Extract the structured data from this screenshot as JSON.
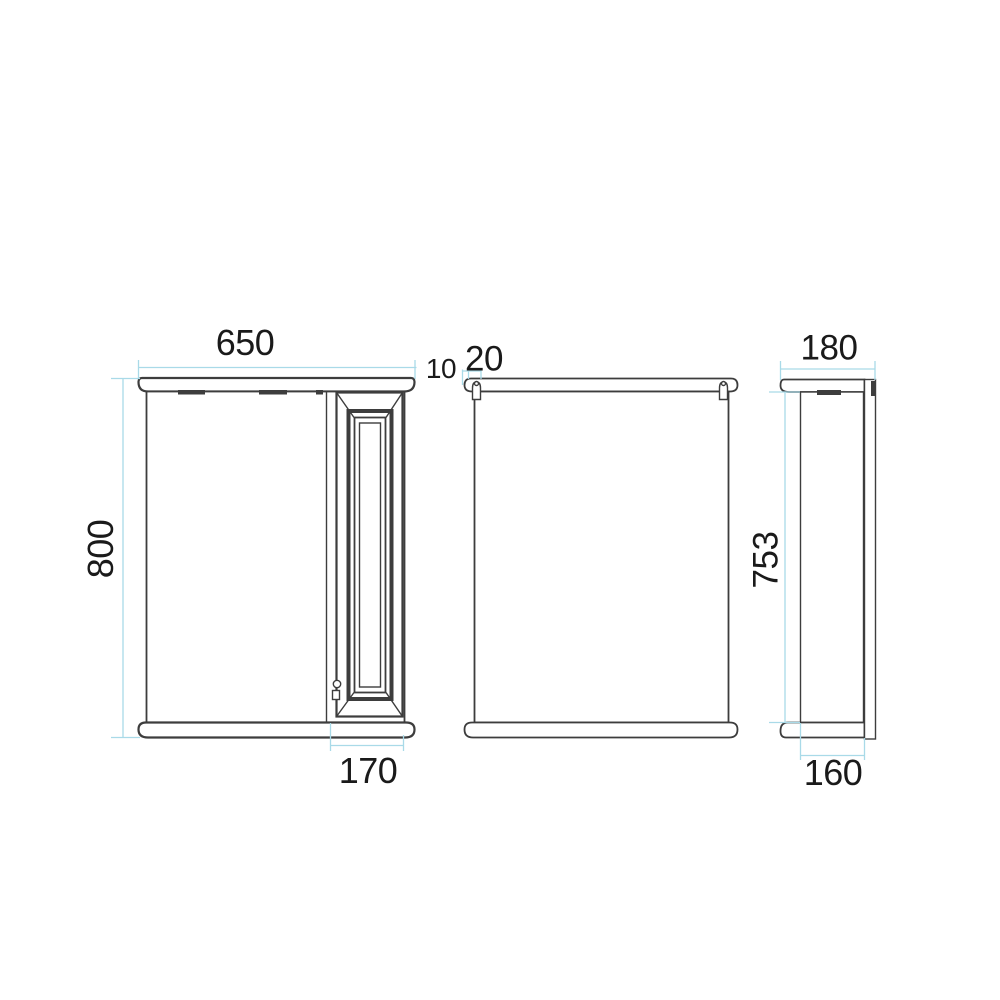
{
  "colors": {
    "background": "#ffffff",
    "object_line": "#3d3d3d",
    "dimension_line": "#a9dae8",
    "label_text": "#1a1a1a"
  },
  "drawing": {
    "front_view": {
      "width_label": "650",
      "height_label": "800",
      "door_width_label": "170"
    },
    "back_view": {
      "hanger_dim_small_label": "10",
      "hanger_dim_large_label": "20"
    },
    "side_view": {
      "depth_label": "180",
      "body_height_label": "753",
      "bottom_depth_label": "160"
    }
  }
}
